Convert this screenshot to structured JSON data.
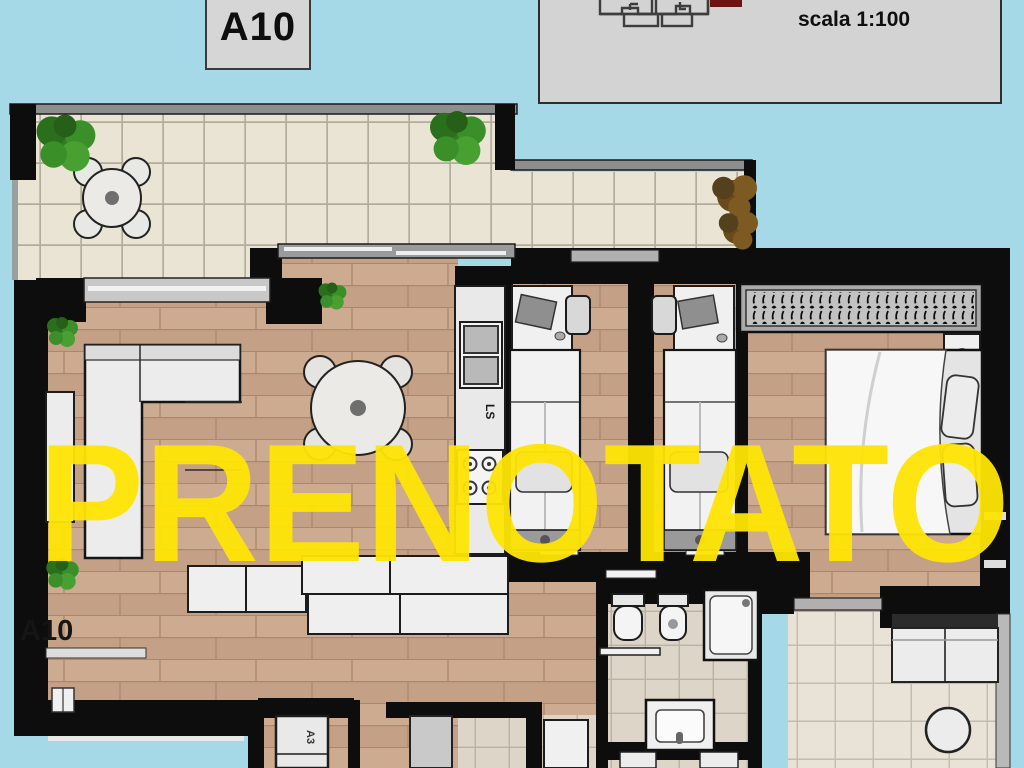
{
  "colors": {
    "background": "#a6d9e8",
    "watermark_yellow": "#ffe505",
    "wall_black": "#0d0d0d"
  },
  "unit_badge": {
    "label": "A10"
  },
  "key_plan_panel": {
    "scale_label": "scala 1:100"
  },
  "floor_plan": {
    "unit_label": "A10",
    "kitchen_counter_label": "LS",
    "hall_cabinet_label": "A3"
  },
  "watermark": {
    "text": "PRENOTATO",
    "color": "#ffe505"
  }
}
